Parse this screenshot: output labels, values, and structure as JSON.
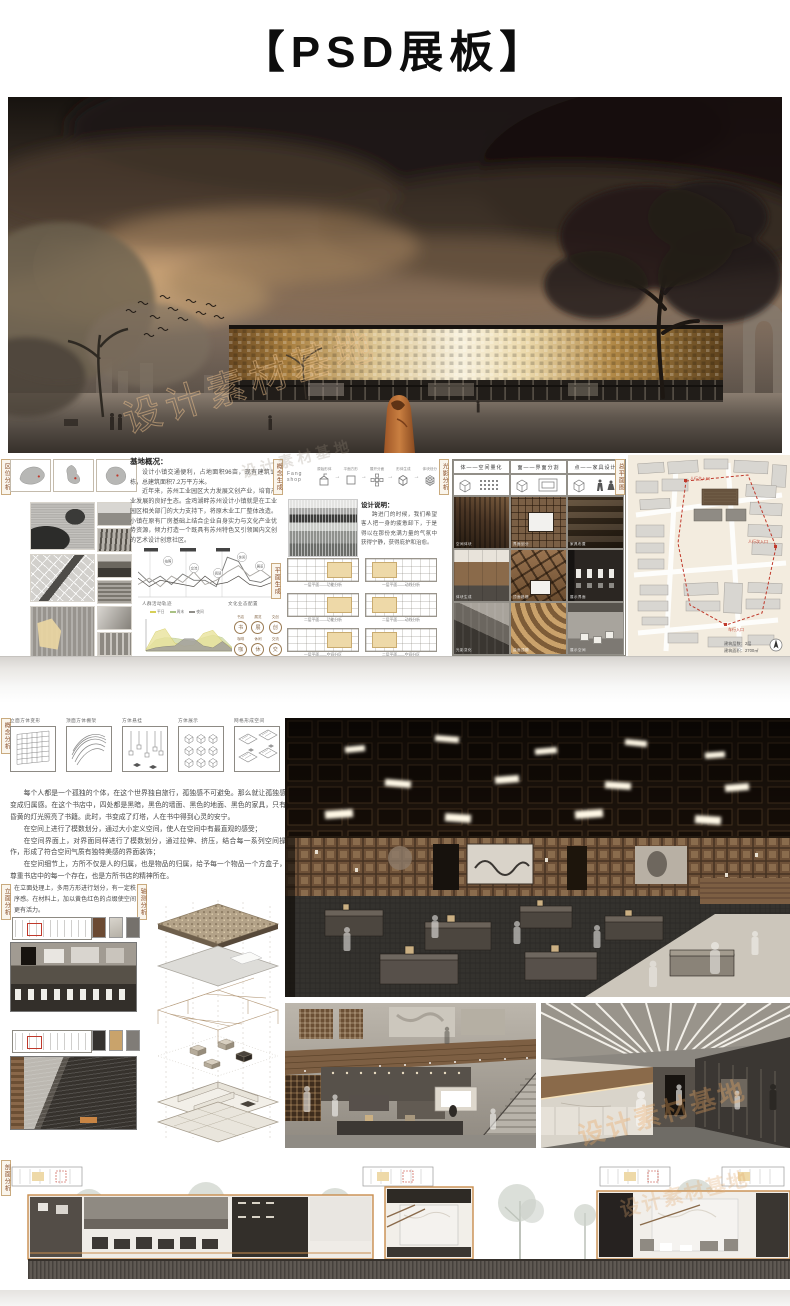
{
  "page": {
    "title": "【PSD展板】",
    "watermark": "设计素材基地"
  },
  "tags": {
    "quwei": "区位分析",
    "gainian_shengcheng": "概念生成",
    "pingmian_shengcheng": "平面生成",
    "guangying": "光影分析",
    "zongpingmian": "总平面图",
    "gainian_fenxi": "概念分析",
    "limian": "立面分析",
    "zhouce": "轴测分析",
    "poumian": "剖面分析"
  },
  "site_overview": {
    "title": "基地概况：",
    "p1": "设计小镇交通便利，占地面积96亩，现有建筑12栋，总建筑面积7.2万平方米。",
    "p2": "近年来，苏州工业园区大力发展文创产业，培育产业发展的良好生态。金鸡湖畔苏州设计小镇就是在工业园区相关部门的大力支持下，将原木业工厂整体改造。小镇在原有厂房基础上结合企业自身实力与文化产业优势资源，倾力打造一个既具有苏州特色又引领国内文创的艺术设计创意社区。"
  },
  "concept_row": {
    "brand": "Fang shop",
    "steps": [
      "原始形体",
      "平面方形",
      "展开分面",
      "形体生成",
      "体块划分"
    ]
  },
  "design_note": {
    "title": "设计说明：",
    "body": "跨进门的时候，我们希望客人把一身的疲惫卸下，于是得以在那份充满力量的气氛中获得宁静，获得庇护和治愈。"
  },
  "chart_data": [
    {
      "type": "line",
      "title": "人群活动轨迹",
      "caption_right": "文化业态配置",
      "callouts": [
        "拍照",
        "交流",
        "阅读",
        "休闲",
        "展览"
      ],
      "series": [
        {
          "name": "人流",
          "values": [
            55,
            30,
            45,
            25,
            50,
            35,
            35,
            20,
            90,
            80,
            35,
            30,
            45
          ]
        },
        {
          "name": "活动",
          "values": [
            25,
            40,
            20,
            45,
            30,
            55,
            25,
            35,
            55,
            70,
            45,
            60,
            40
          ]
        },
        {
          "name": "停留",
          "values": [
            40,
            20,
            35,
            30,
            25,
            20,
            45,
            25,
            30,
            45,
            25,
            20,
            30
          ]
        }
      ]
    },
    {
      "type": "area",
      "legend": [
        "平日",
        "周末",
        "夜间"
      ],
      "series": [
        {
          "name": "平日",
          "values": [
            5,
            60,
            70,
            25,
            15,
            18,
            55,
            65,
            30,
            10
          ]
        },
        {
          "name": "周末",
          "values": [
            3,
            35,
            42,
            40,
            35,
            30,
            42,
            50,
            42,
            12
          ]
        },
        {
          "name": "夜间",
          "values": [
            2,
            10,
            14,
            16,
            38,
            38,
            16,
            10,
            30,
            6
          ]
        }
      ]
    }
  ],
  "program_icons": [
    {
      "glyph": "书",
      "label": "书店"
    },
    {
      "glyph": "展",
      "label": "展览"
    },
    {
      "glyph": "创",
      "label": "文创"
    },
    {
      "glyph": "咖",
      "label": "咖啡"
    },
    {
      "glyph": "休",
      "label": "休闲"
    },
    {
      "glyph": "交",
      "label": "交流"
    }
  ],
  "plans": [
    "一层平面——功能分析",
    "一层平面——动线分析",
    "二层平面——功能分析",
    "二层平面——动线分析",
    "一层平面——空间分区",
    "二层平面——空间分区"
  ],
  "light_grid": {
    "headers": [
      "体——空间量化",
      "面——界面分割",
      "点——家具设计"
    ],
    "captions": [
      "空间体块",
      "界面划分",
      "家具布置",
      "体块生成",
      "顶面格栅",
      "展示界面",
      "光影变化",
      "曲面顶棚",
      "展示空间"
    ]
  },
  "master_plan": {
    "entrances": [
      "人行主入口",
      "人行次入口",
      "车行入口"
    ],
    "stats": [
      "建筑层数：2层",
      "建筑面积：2700㎡"
    ]
  },
  "lower": {
    "diagram_labels": [
      "立面方体变形",
      "顶面方体棚架",
      "方体悬挂",
      "方体展示",
      "网格形成空间"
    ],
    "p1": "每个人都是一个孤独的个体，在这个世界独自旅行，孤独感不可避免。那么就让孤独感变成归属感。在这个书店中，四处都是黑暗，黑色的墙面、黑色的地面、黑色的家具，只有昏黄的灯光照亮了书籍。此时，书变成了灯塔，人在书中得到心灵的安宁。",
    "p2": "在空间上进行了模数划分，通过大小定义空间，使人在空间中有最直观的感受；",
    "p3": "在空间界面上，对界面同样进行了模数划分，通过拉伸、挤压，结合每一系列空间操作，形成了符合空间气质有独特美感的界面装饰；",
    "p4": "在空间细节上，方所不仅是人的归属，也是物品的归属，给予每一个物品一个方盒子，尊重书店中的每一个存在，也是方所书店的精神所在。",
    "facade_note": "在立面处理上，多用方形进行划分，有一定秩序感。在材料上，加以黄色红色的点缀使空间更有活力。"
  }
}
